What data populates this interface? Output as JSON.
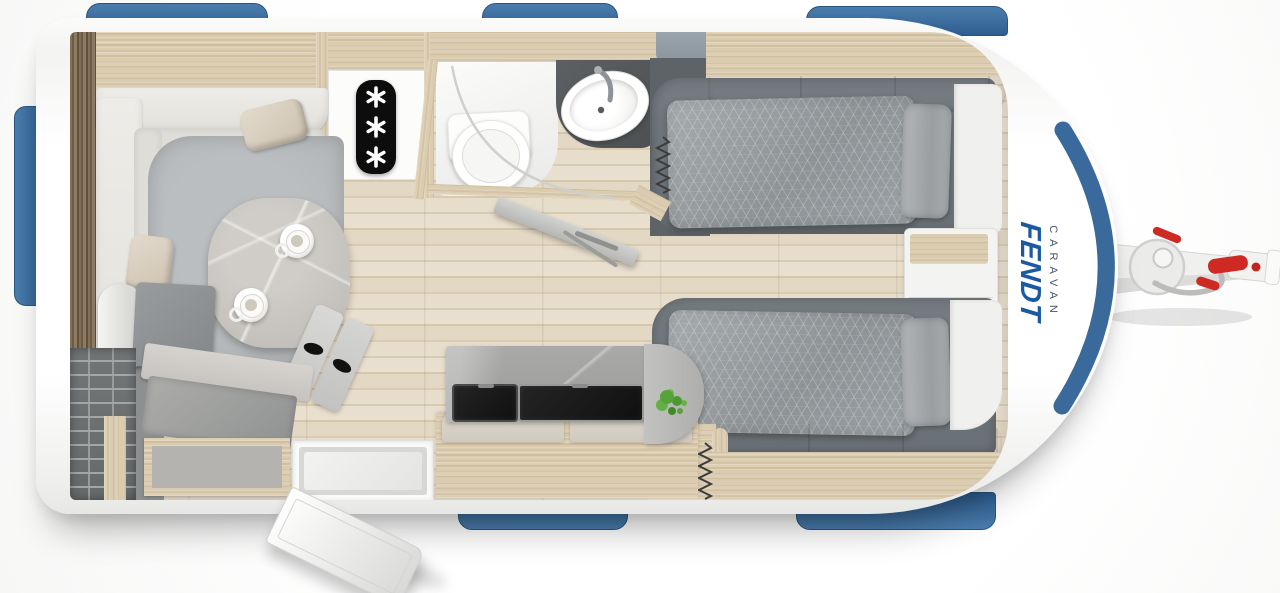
{
  "scene": {
    "description": "Top-down 3D rendered floor plan of a Fendt caravan",
    "view": "top-view"
  },
  "brand": {
    "name": "FENDT",
    "line": "CARAVAN",
    "name_color": "#1b59a3",
    "line_color": "#46566b"
  },
  "palette": {
    "window_blue": "#3a699c",
    "body_white": "#ffffff",
    "oak_wood": "#d8c9ac",
    "dark_wood": "#77634c",
    "floor_plank": "#e2d6c2",
    "lounge_carpet": "#b4b7b9",
    "bed_frame_gray": "#6f767b",
    "duvet_gray": "#999fa2",
    "counter_gray": "#a5a6a4",
    "appliance_black": "#181818",
    "hitch_red": "#ce2a23",
    "plant_green": "#57a33a"
  },
  "icons": {
    "freezer_icon": "black panel with three stacked snowflake asterisks",
    "bed_spring_icon": "zigzag spring symbol (one per bed)",
    "coffee_cup_icon": "two coffee cups on lounge table",
    "plant_icon": "green plant on kitchen end shelf"
  },
  "rooms": {
    "lounge": "front lounge with L-shaped sofa, cushions, pedestal table, slipper mat",
    "washroom": "corner washroom with toilet, corner basin and open door",
    "kitchen": "galley kitchen with dark hob/sink covers and worktop",
    "bedroom": "two single beds with nightstand between them",
    "wardrobe": "wire-shelf wardrobe in rear corner",
    "entry": "entry door shown swung open at bottom"
  },
  "exterior": {
    "windows_top": 3,
    "windows_bottom": 2,
    "windows_rear": 1,
    "hitch": "tow hitch with jockey wheel, coupling head and red handles"
  }
}
